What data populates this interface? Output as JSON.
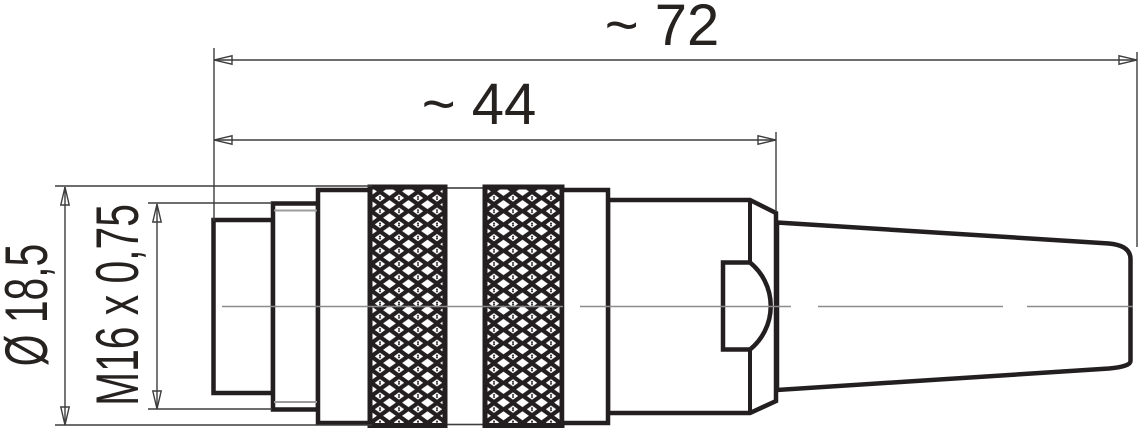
{
  "drawing": {
    "type": "connector-technical-drawing",
    "view": "side-view",
    "dimensions": {
      "overall_length": {
        "label": "~ 72",
        "unit": "mm"
      },
      "front_length": {
        "label": "~ 44",
        "unit": "mm"
      },
      "outer_diameter": {
        "label": "Ø 18,5",
        "unit": "mm"
      },
      "thread": {
        "label": "M16 x 0,75"
      }
    },
    "colors": {
      "background": "#ffffff",
      "outline": "#231f20",
      "dimension": "#3d3d3d",
      "secondary": "#9b9b9b",
      "centerline": "#8c8c8c",
      "text": "#262220"
    }
  }
}
